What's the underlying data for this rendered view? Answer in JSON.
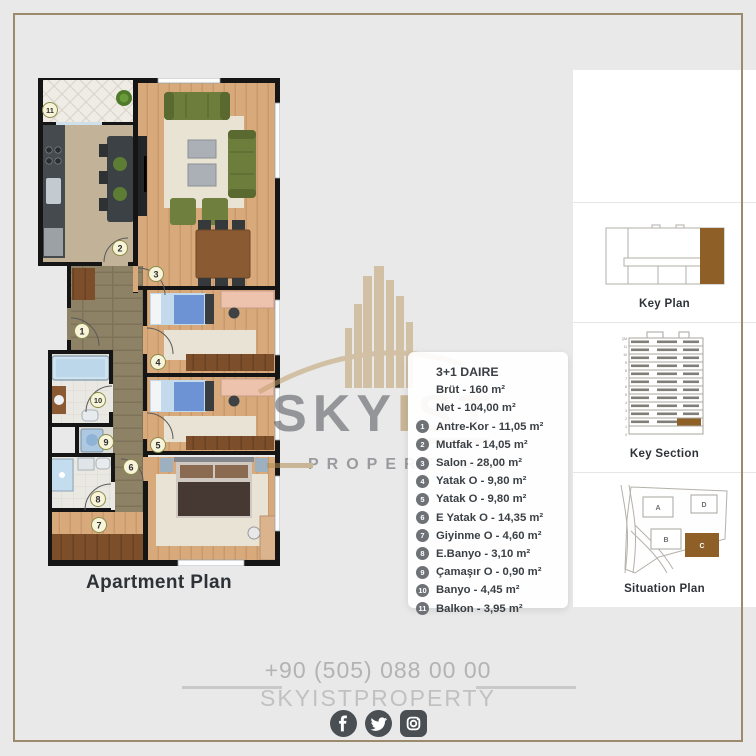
{
  "plan": {
    "caption": "Apartment Plan",
    "numbers": [
      "1",
      "2",
      "3",
      "4",
      "5",
      "6",
      "7",
      "8",
      "9",
      "10",
      "11"
    ]
  },
  "legend": {
    "title": "3+1 DAIRE",
    "brut": "Brüt - 160 m²",
    "net": "Net - 104,00 m²",
    "items": [
      {
        "num": "1",
        "label": "Antre-Kor - 11,05 m²"
      },
      {
        "num": "2",
        "label": "Mutfak - 14,05 m²"
      },
      {
        "num": "3",
        "label": "Salon - 28,00 m²"
      },
      {
        "num": "4",
        "label": "Yatak O - 9,80 m²"
      },
      {
        "num": "5",
        "label": "Yatak O - 9,80 m²"
      },
      {
        "num": "6",
        "label": "E Yatak O - 14,35 m²"
      },
      {
        "num": "7",
        "label": "Giyinme O - 4,60 m²"
      },
      {
        "num": "8",
        "label": "E.Banyo - 3,10 m²"
      },
      {
        "num": "9",
        "label": "Çamaşır O - 0,90 m²"
      },
      {
        "num": "10",
        "label": "Banyo - 4,45 m²"
      },
      {
        "num": "11",
        "label": "Balkon - 3,95 m²"
      }
    ]
  },
  "watermark": {
    "sky": "SKY",
    "ist": "IST",
    "property": "PROPERTY"
  },
  "side_panels": {
    "key_plan_label": "Key Plan",
    "key_section_label": "Key Section",
    "situation_plan_label": "Situation Plan",
    "key_section_floors": [
      "ÇM",
      "11",
      "10",
      "9",
      "8",
      "7",
      "6",
      "5",
      "4",
      "3",
      "2",
      "1",
      "0"
    ],
    "situation_blocks": [
      "A",
      "B",
      "C",
      "D"
    ]
  },
  "footer": {
    "phone": "+90 (505) 088 00 00",
    "brand": "SKYISTPROPERTY",
    "social": [
      "facebook",
      "twitter",
      "instagram"
    ]
  },
  "colors": {
    "frame_tan": "#9b8a6b",
    "highlight_brown": "#8f5f28",
    "watermark_tan": "#b08e55",
    "text_dark": "#3b4045",
    "footer_gray": "#b3b3b3",
    "social_dark": "#4a4f54"
  }
}
